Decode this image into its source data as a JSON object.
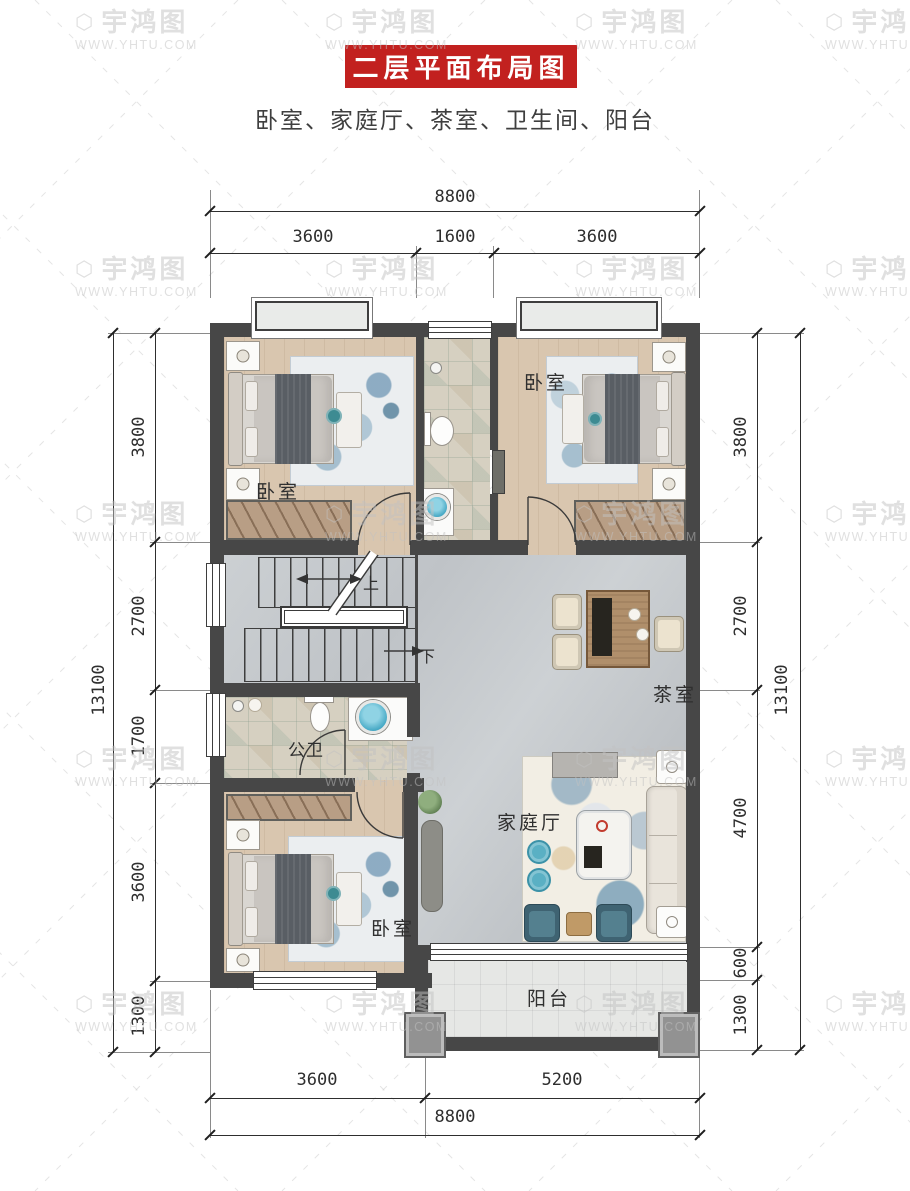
{
  "header": {
    "title": "二层平面布局图",
    "subtitle": "卧室、家庭厅、茶室、卫生间、阳台"
  },
  "watermark": {
    "logo": "⬡",
    "brand": "宇鸿图",
    "url": "WWW.YHTU.COM"
  },
  "rooms": {
    "bedroom_top_left": "卧室",
    "bedroom_top_right": "卧室",
    "bedroom_bottom_left": "卧室",
    "public_bathroom": "公卫",
    "tea_room": "茶室",
    "family_hall": "家庭厅",
    "balcony": "阳台",
    "stair_up": "上",
    "stair_down": "下"
  },
  "dims": {
    "top_total": "8800",
    "top_segments": [
      "3600",
      "1600",
      "3600"
    ],
    "bottom_segments": [
      "3600",
      "5200"
    ],
    "bottom_total": "8800",
    "left_total": "13100",
    "left_segments": [
      "3800",
      "2700",
      "1700",
      "3600",
      "1300"
    ],
    "right_total": "13100",
    "right_segments": [
      "3800",
      "2700",
      "4700",
      "600",
      "1300"
    ]
  },
  "colors": {
    "banner_red": "#c2211f",
    "wall_dark": "#474747",
    "accent_teal": "#52b7d4"
  }
}
